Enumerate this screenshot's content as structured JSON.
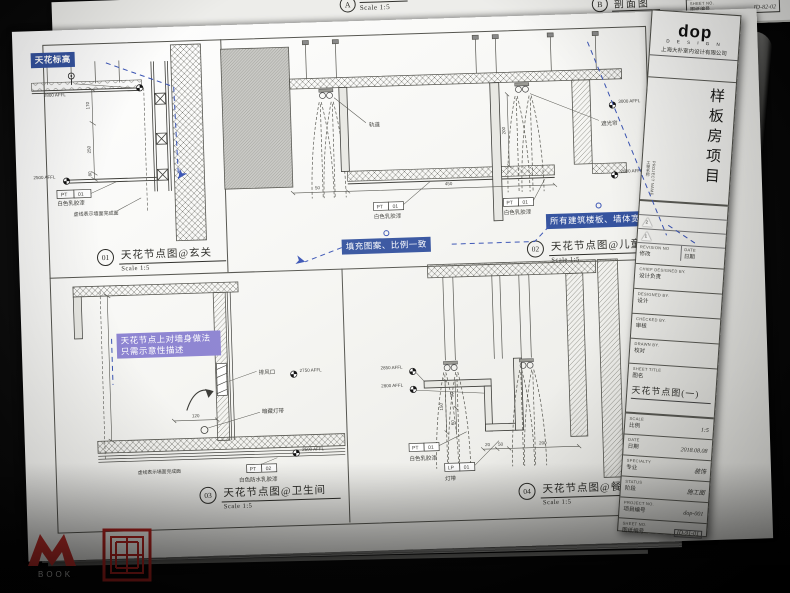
{
  "prev_page": {
    "a_label": "A",
    "a_title": "剖面图",
    "a_scale": "Scale 1:5",
    "b_label": "B",
    "b_title": "剖面图",
    "b_scale": "Scale 1:5",
    "frag_proj_cn": "项目编号",
    "frag_proj_val": "dop-001",
    "frag_sheet_cap": "SHEET NO.",
    "frag_sheet_cn": "图纸编号",
    "frag_sheet_val": "ID-82-02"
  },
  "callouts": {
    "ceiling_level": "天花标高",
    "fill_note": "填充图案、比例一致",
    "slab_note": "所有建筑楼板、墙体宽度一致",
    "wall_note1": "天花节点上对墙身做法",
    "wall_note2": "只需示意性描述"
  },
  "v01": {
    "num": "01",
    "title": "天花节点图@玄关",
    "scale": "Scale 1:5",
    "lv_top": "2800 AFFL",
    "lv_mid": "2500 AFFL",
    "d1": "170",
    "d2": "250",
    "d3": "80",
    "pt": "PT",
    "ptn": "01",
    "pt_desc": "白色乳胶漆",
    "note": "虚线表示墙面完成面"
  },
  "v02": {
    "num": "02",
    "title": "天花节点图@儿童房",
    "scale": "Scale 1:5",
    "track": "轨道",
    "curtain": "遮光帘",
    "lv_top": "3000 AFFL",
    "lv_mid": "2800 AFFL",
    "d1": "450",
    "d2": "200",
    "d3": "50",
    "pt": "PT",
    "ptn": "01",
    "pt_desc": "白色乳胶漆"
  },
  "v03": {
    "num": "03",
    "title": "天花节点图@卫生间",
    "scale": "Scale 1:5",
    "vent": "排风口",
    "strip": "暗藏灯带",
    "lv_top": "2750 AFFL",
    "lv_mid": "2500 AFFL",
    "d1": "120",
    "pt": "PT",
    "ptn": "02",
    "pt_desc": "白色防水乳胶漆",
    "note": "虚线表示墙面完成面"
  },
  "v04": {
    "num": "04",
    "title": "天花节点图@餐厅",
    "scale": "Scale 1:5",
    "lv_top": "2850 AFFL",
    "lv_mid": "2800 AFFL",
    "d1": "150",
    "d2": "90",
    "d3": "60",
    "d4": "200",
    "d5": "50",
    "d6": "20",
    "pt": "PT",
    "ptn": "01",
    "pt_desc": "白色乳胶漆",
    "lp": "LP",
    "lpn": "01",
    "lp_desc": "灯带"
  },
  "titleblock": {
    "logo": "dop",
    "logo_sub": "D E S I G N",
    "company": "上海大朴室内设计有限公司",
    "project_name_cn": "样板房项目",
    "project_caption": "PROJECT NAME",
    "project_caption_cn": "工程名称",
    "rev_no": "REVISION NO",
    "rev_date": "DATE",
    "rev_no_cn": "修改",
    "rev_date_cn": "日期",
    "tri1": "1",
    "tri2": "2",
    "chief_caption": "CHIEF DESIGNED BY.",
    "chief_cn": "设计负责",
    "designed_caption": "DESIGNED BY.",
    "designed_cn": "设计",
    "checked_caption": "CHECKED BY.",
    "checked_cn": "审核",
    "drawn_caption": "DRAWN BY.",
    "drawn_cn": "校对",
    "sheet_title_caption": "SHEET TITLE",
    "sheet_title_cn": "图名",
    "sheet_title": "天花节点图(一)",
    "scale_caption": "SCALE",
    "scale_cn": "比例",
    "scale_value": "1:5",
    "date_caption": "DATE",
    "date_cn": "日期",
    "date_value": "2018.08.08",
    "spec_caption": "SPECIALTY",
    "spec_cn": "专业",
    "spec_value": "装饰",
    "status_caption": "STATUS",
    "status_cn": "阶段",
    "status_value": "施工图",
    "projno_caption": "PROJECT NO.",
    "projno_cn": "项目编号",
    "projno_value": "dop-001",
    "sheetno_caption": "SHEET NO.",
    "sheetno_cn": "图纸编号",
    "sheetno_value": "ID-91-01"
  },
  "corner_tb": {
    "proj_cap": "PROJECT NO.",
    "proj_cn": "项目编号",
    "sheet_cap": "SHEET NO.",
    "sheet_cn": "图纸编号"
  },
  "watermark": {
    "book": "BOOK"
  }
}
